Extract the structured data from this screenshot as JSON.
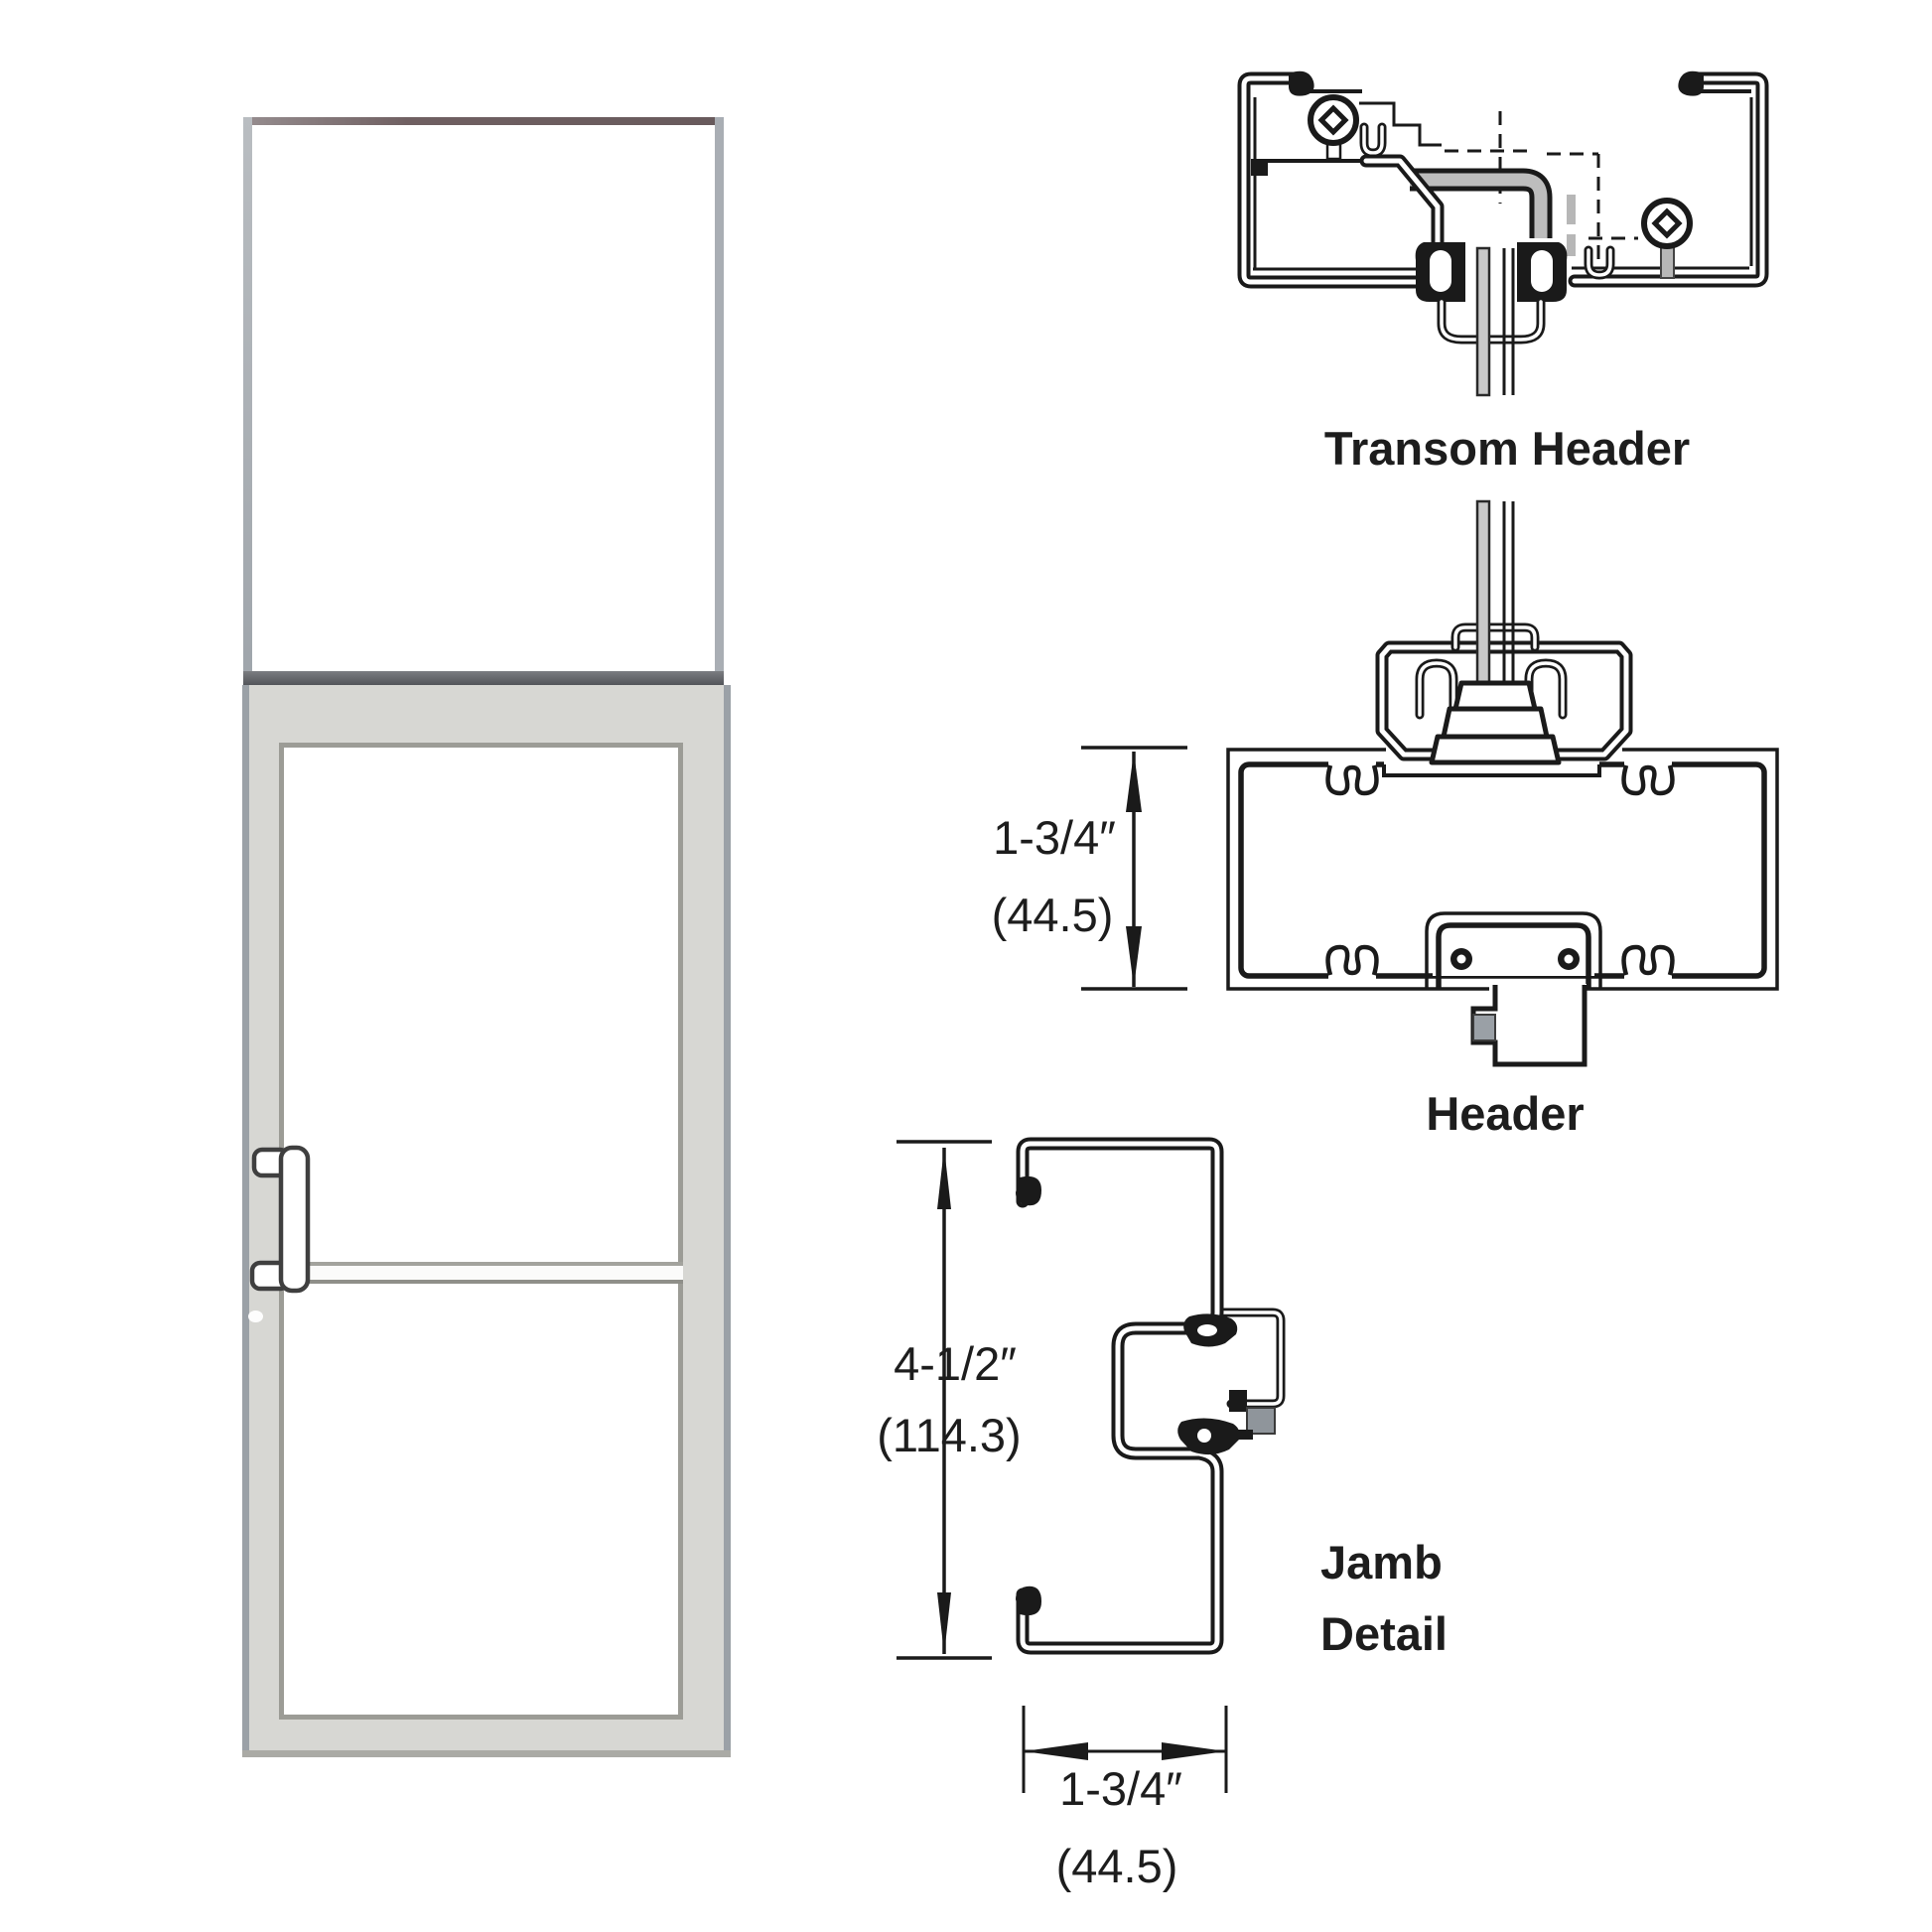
{
  "details": {
    "transom_header": {
      "label": "Transom Header"
    },
    "header": {
      "label": "Header",
      "dimension": {
        "imperial": "1-3/4″",
        "metric": "(44.5)"
      }
    },
    "jamb": {
      "label": [
        "Jamb",
        "Detail"
      ],
      "height_dimension": {
        "imperial": "4-1/2″",
        "metric": "(114.3)"
      },
      "width_dimension": {
        "imperial": "1-3/4″",
        "metric": "(44.5)"
      }
    }
  },
  "colors": {
    "line": "#1a1a1a",
    "glass_section_fill": "#c9c9c9",
    "door_frame": "#d7d7d3",
    "door_edge": "#9ba1a7",
    "transom_frame": "#a9aeb4",
    "transom_top_rail": "#6f5f61",
    "transom_sill": "#55575b",
    "glass_stop_block": "#9aa0a6",
    "background": "#ffffff"
  }
}
